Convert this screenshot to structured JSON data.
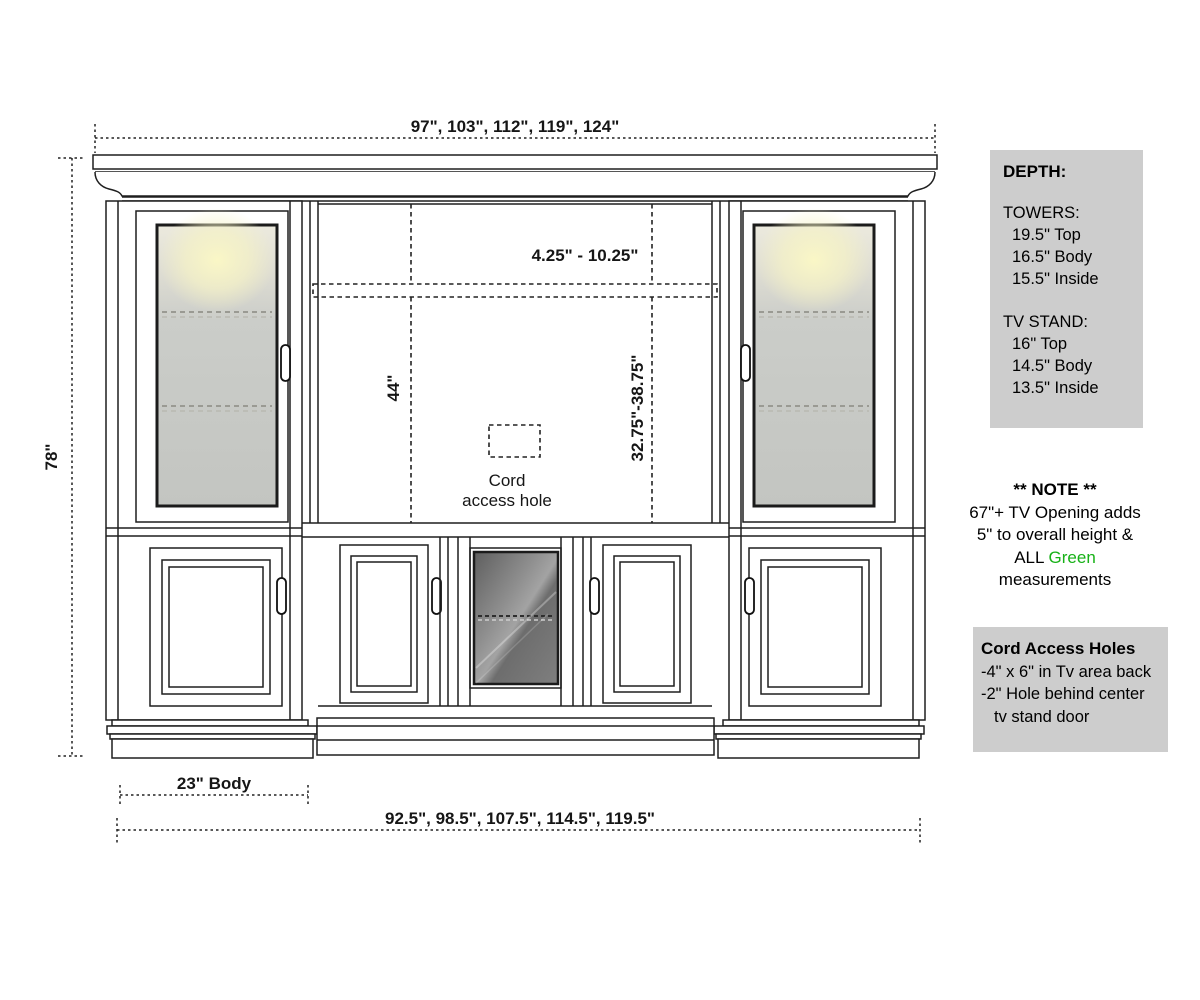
{
  "dims": {
    "top_width": "97\", 103\", 112\", 119\", 124\"",
    "height": "78\"",
    "shelf_range": "4.25\" - 10.25\"",
    "tv_height": "44\"",
    "tv_opening": "32.75\"-38.75\"",
    "cord_line1": "Cord",
    "cord_line2": "access hole",
    "body_width": "23\" Body",
    "bottom_width": "92.5\", 98.5\", 107.5\", 114.5\", 119.5\""
  },
  "depth_panel": {
    "title": "DEPTH:",
    "towers_title": "TOWERS:",
    "towers": [
      "19.5\" Top",
      "16.5\" Body",
      "15.5\" Inside"
    ],
    "tv_title": "TV STAND:",
    "tv": [
      "16\" Top",
      "14.5\" Body",
      "13.5\" Inside"
    ]
  },
  "note_panel": {
    "title": "** NOTE **",
    "line1": "67\"+ TV Opening adds",
    "line2": "5\" to overall height &",
    "line3_prefix": "ALL",
    "line3_green": "Green",
    "line4": "measurements"
  },
  "cord_panel": {
    "title": "Cord Access Holes",
    "line1": "-4\" x 6\" in Tv area back",
    "line2": "-2\" Hole behind center",
    "line3": "tv stand door"
  },
  "colors": {
    "green": "#17b117",
    "panel_bg": "#cdcdcd",
    "line": "#1f1f1f"
  }
}
